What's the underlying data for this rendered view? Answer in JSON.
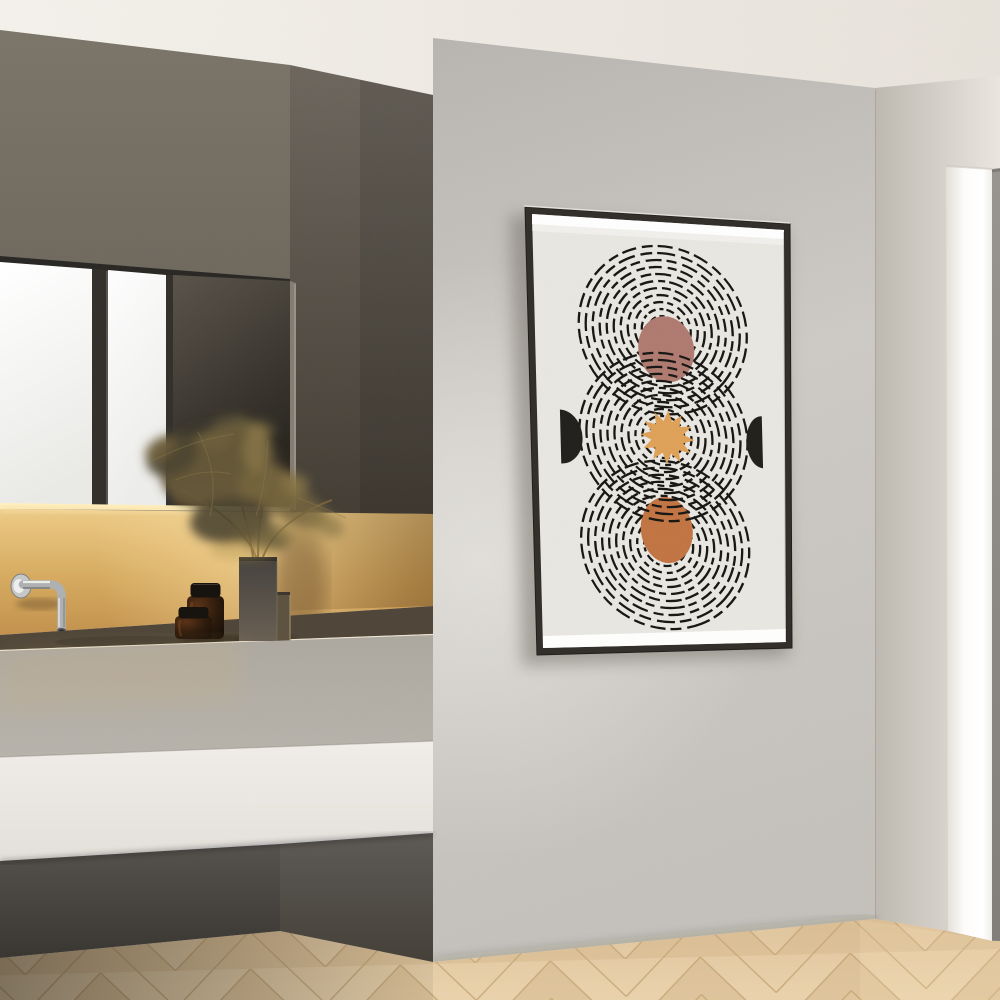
{
  "meta": {
    "title": "Modern concrete bathroom interior with framed abstract circle art",
    "media": "photographic interior render, no visible text",
    "canvas": {
      "width": 1000,
      "height": 1000
    }
  },
  "scene": {
    "elements": [
      "ceiling",
      "concrete-feature-wall",
      "framed-abstract-poster",
      "mirror-cabinet-with-window-reflection",
      "under-cabinet-warm-light",
      "wall-mounted-chrome-faucet",
      "amber-glass-jar-large",
      "amber-glass-jar-small",
      "stepped-concrete-vase",
      "dried-pampas-grass",
      "floating-concrete-vanity-counter",
      "herringbone-wood-floor",
      "doorway-with-white-jamb-and-grey-door"
    ]
  },
  "palette": {
    "ceiling_left": "#F4F1EB",
    "ceiling_right": "#E7E2DA",
    "wall_top": "#B8B5B0",
    "wall_mid": "#CDCAC5",
    "wall_bottom": "#C4C1BB",
    "wall_glow": "#F4F2EE",
    "right_wall_near": "#BDB8B0",
    "right_wall_far": "#EAE6DF",
    "pillar_shade": "#E2DED7",
    "pillar_white": "#FDFCFA",
    "door_top": "#989490",
    "door_bottom": "#827E79",
    "alcove_top": "#7A7468",
    "alcove_bottom": "#625B51",
    "side_top": "#6B655C",
    "side_bottom": "#413B32",
    "mirror_white": "#FFFFFF",
    "mirror_white_dim": "#E9E9E6",
    "mirror_frame": "#34312D",
    "mirror_dark_top": "#5A544B",
    "mirror_dark_bottom": "#28251F",
    "mirror_side_edge": "#837D73",
    "light_strip": "#FFEFBE",
    "glow_top": "#ECCB87",
    "glow_mid": "#D6AA60",
    "glow_bottom": "#C2924E",
    "glow_hot": "#F7DCA0",
    "glow_shadow": "#6F4E24",
    "counter_top_dark": "#50473A",
    "counter_edge_light": "#EFE5D2",
    "counter_face_top": "#ACA89F",
    "counter_face_bottom": "#B7B3AB",
    "fascia_top": "#F0EDE8",
    "fascia_bottom": "#E3E0DA",
    "under_top": "#56524E",
    "under_bottom": "#3A3733",
    "under_mid": "#5E5A56",
    "under_mid2": "#454139",
    "floor_base": "#DFC49D",
    "floor_light": "#EFDCB6",
    "floor_chevron": "#D6B88D",
    "floor_seam": "#C3A375",
    "chrome_light": "#F2F3F3",
    "chrome_mid": "#AEB0B1",
    "chrome_dark": "#737678",
    "jar_body": "#2E1C0D",
    "jar_lid": "#17130E",
    "jar_glint": "#8A4E22",
    "vase_top": "#45423E",
    "vase_bottom": "#6A6054",
    "vase_step": "#5E5340",
    "vase_edge": "#A08C6B",
    "pampas_dark": "#4E4530",
    "pampas_main": "#655939",
    "pampas_mid": "#75653F",
    "pampas_light": "#8F7B49",
    "pampas_warm": "#A98D52",
    "pampas_stem": "#7A6438",
    "pampas_reflection": "#4A4230"
  },
  "poster": {
    "frame_color": "#33302B",
    "frame_edge_light": "#E7E4DF",
    "paper": "#E9E7E2",
    "ring_color": "#171511",
    "ring_groups": 3,
    "rings_per_group": 11,
    "glass_reflection": "#FFFFFF",
    "moon_color": "#AF7A70",
    "star_color": "#DFA158",
    "star_points": 12,
    "oval_color": "#C27442",
    "half_disc_color": "#211F1B"
  }
}
